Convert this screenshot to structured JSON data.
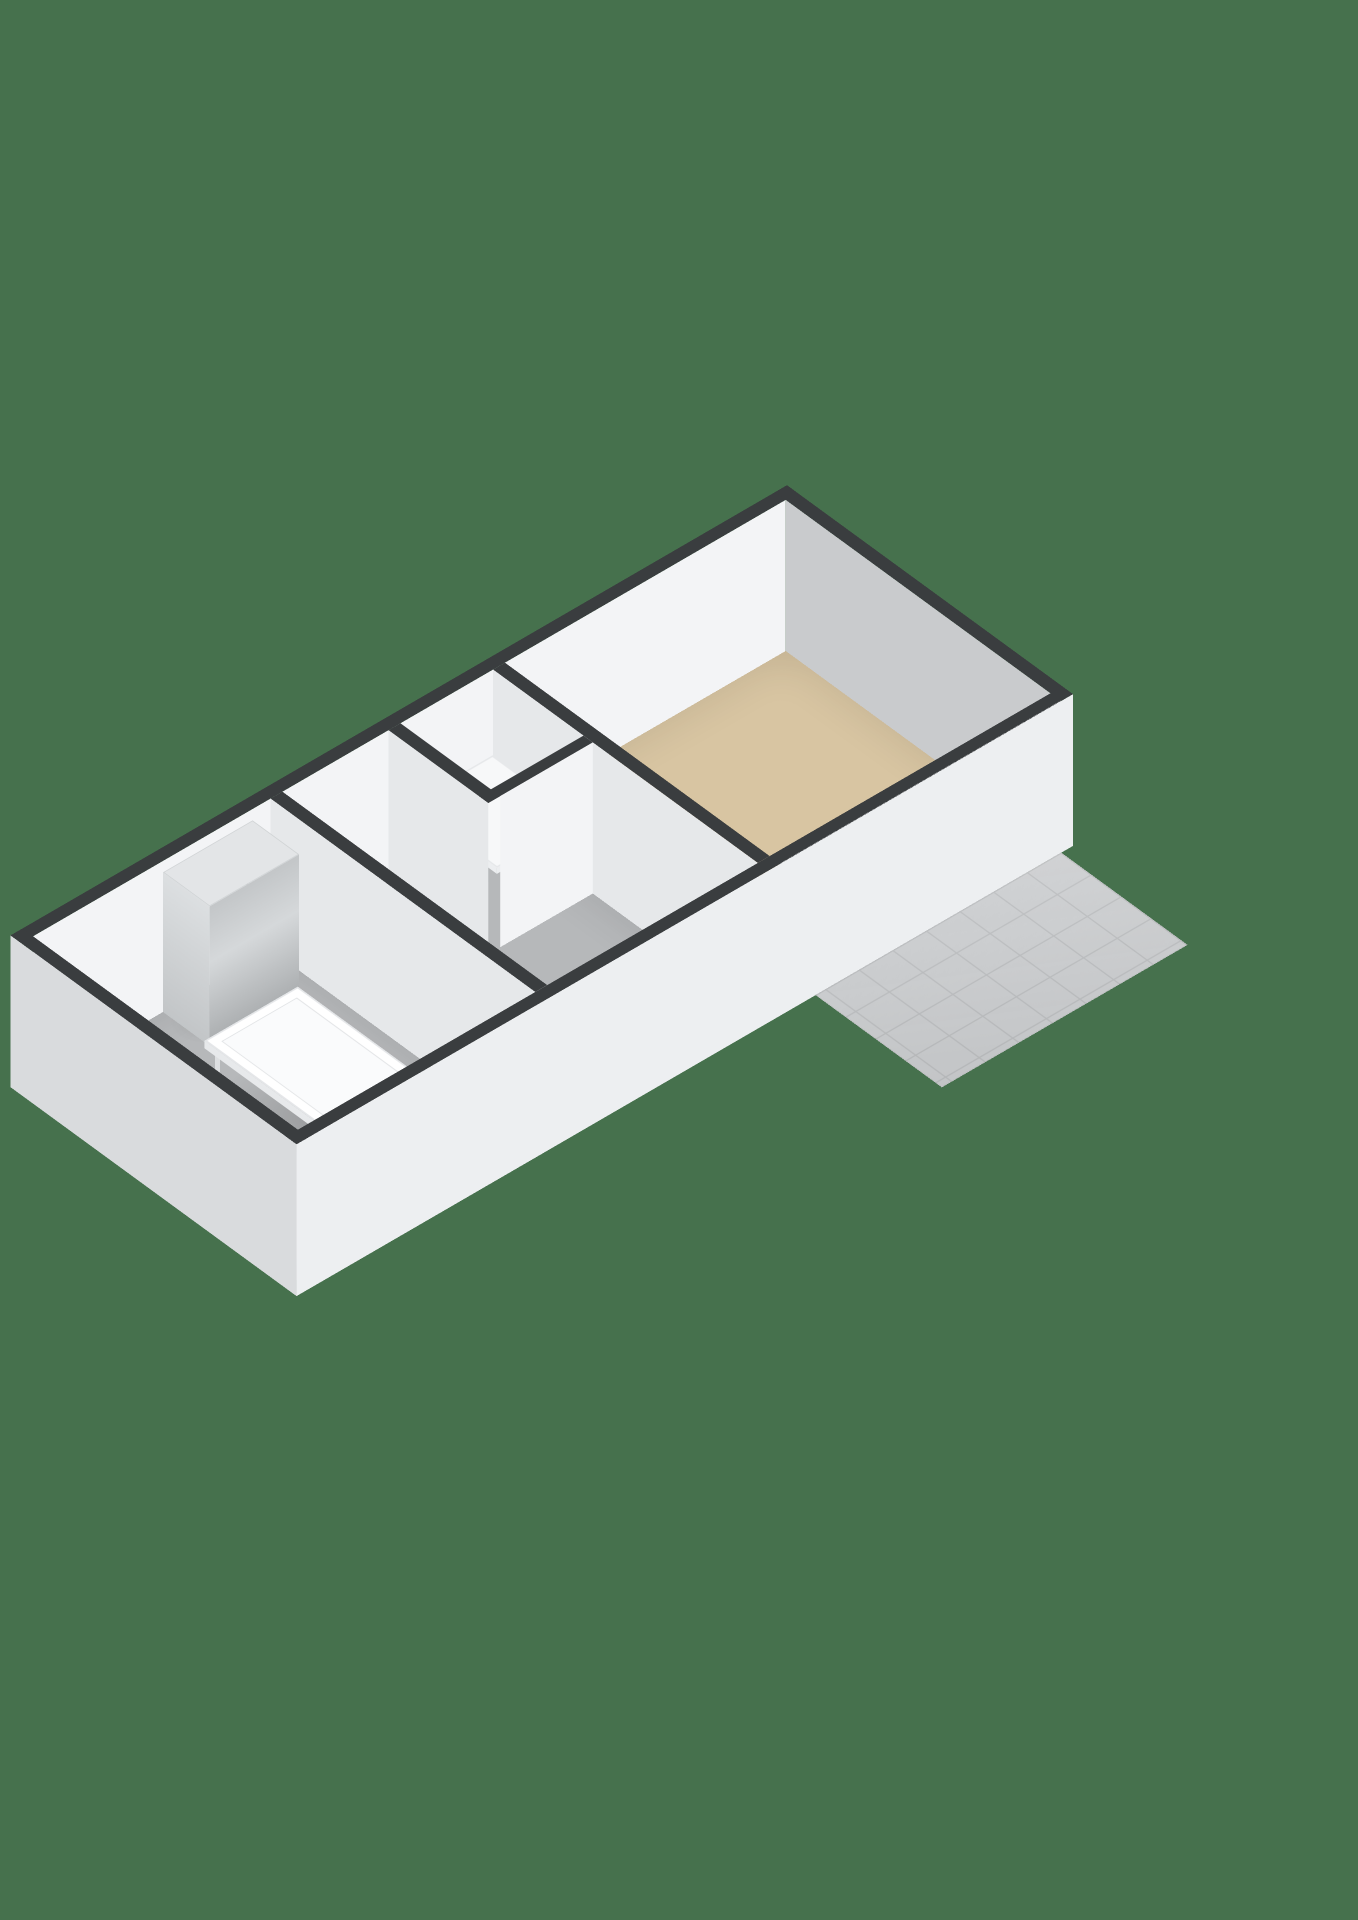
{
  "scene": {
    "type": "isometric-3d-floor-plan",
    "description": "3D rendered floor plan of a garden house / garage building on a plain green background",
    "background": "#46714d"
  },
  "building": {
    "rooms": [
      {
        "id": "garden-room",
        "floor": "beige",
        "features": [
          "kitchen-counter",
          "sink",
          "glass-door-wall",
          "end-cabinet"
        ]
      },
      {
        "id": "hallway",
        "floor": "gray",
        "features": [
          "front-door",
          "interior-door-to-garden-room",
          "interior-door-to-garage"
        ]
      },
      {
        "id": "storage-closet",
        "floor": "gray",
        "features": [
          "shelf"
        ]
      },
      {
        "id": "garage",
        "floor": "gray",
        "features": [
          "roller-garage-door",
          "refrigerator",
          "work-table",
          "front-window"
        ]
      }
    ],
    "exterior": [
      "tiled-patio-terrace",
      "glass-french-doors",
      "roller-garage-door",
      "front-door-with-glass",
      "front-window"
    ],
    "glass_door_panels": 5
  },
  "colors": {
    "bg": "#46714d",
    "wallTop": "#3a3d3f",
    "wallBright": "#f3f4f6",
    "wallSide": "#c9cbcd",
    "wallPart": "#e6e8ea",
    "wallExtFront": "#edeff1",
    "wallExtEnd": "#d9dbdd",
    "floorMain": "#d8c5a2",
    "floorGray": "#b6b8ba",
    "patio": "#cdcfd1",
    "patioGrout": "#bdbfc1",
    "counterTop": "#121315",
    "cabinet": "#f6f7f8",
    "fridgeLight": "#d5d8da",
    "fridgeDark": "#a9acae",
    "fridgeBand": "#0c0d0e",
    "tableTop": "#fafbfc",
    "tableEdge": "#e7e9eb",
    "roller": "#c6c8ca",
    "rollerDark": "#afb1b3",
    "glassBeige": "#d9caa9",
    "glassBeigeLight": "#e8deca",
    "winGlass": "#cfd7db",
    "doorGlass": "#c9d4d9",
    "doorLeaf": "#f6f7f8",
    "frameWhite": "#f4f6f7",
    "handle": "#c6c9cb",
    "handleDark": "#707376",
    "shelf": "#f7f8f9",
    "sinkOuter": "#c6c9cb",
    "sinkInner": "#abaeb0",
    "niche": "#fafbfd",
    "shadow": "rgba(0,0,0,0.14)"
  }
}
